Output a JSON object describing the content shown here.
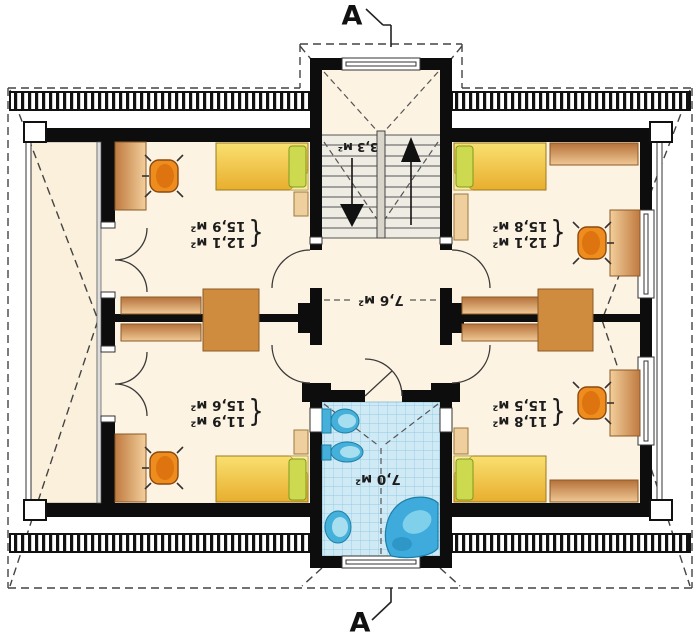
{
  "section_markers": {
    "top": "A",
    "bottom": "A"
  },
  "area_brace": "{",
  "rooms": {
    "top_left": {
      "area_floor": "12,1 м²",
      "area_total": "15,9 м²"
    },
    "top_right": {
      "area_floor": "12,1 м²",
      "area_total": "15,8 м²"
    },
    "bottom_left": {
      "area_floor": "11,9 м²",
      "area_total": "15,6 м²"
    },
    "bottom_right": {
      "area_floor": "11,8 м²",
      "area_total": "15,5 м²"
    },
    "hall": {
      "area": "7,6 м²"
    },
    "stairs": {
      "area": "3,3 м²"
    },
    "bathroom": {
      "area": "7,0 м²"
    }
  },
  "colors": {
    "floor": "#fdf3e2",
    "wall": "#0d0d0d",
    "bed": "#eeb93a",
    "pillow": "#cdd94f",
    "wood_light": "#f0c894",
    "wood_dark": "#bf7a40",
    "chair": "#ef8c1e",
    "tile": "#cfe9f5",
    "tile_grid": "#93cbe4",
    "fixture": "#45b0da"
  },
  "furniture": {
    "bedrooms": [
      "bed",
      "pillow",
      "desk",
      "office-chair",
      "wardrobe",
      "bedside-shelf",
      "dresser"
    ],
    "bathroom": [
      "toilet",
      "bidet",
      "washbasin",
      "corner-bathtub"
    ],
    "stairwell": [
      "staircase",
      "up-arrow",
      "down-arrow"
    ]
  }
}
